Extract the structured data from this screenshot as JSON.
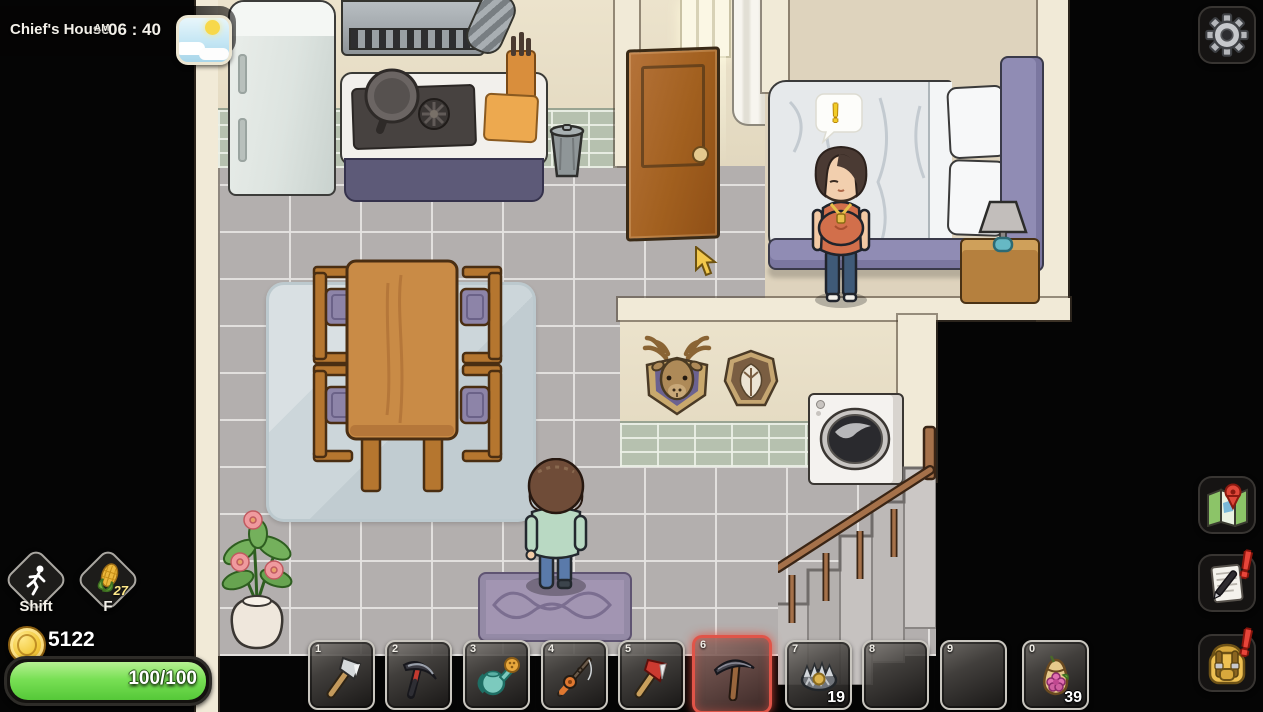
{
  "header": {
    "location": "Chief's House",
    "meridiem": "AM",
    "time": "06 : 40",
    "weather_icon": "sun-and-clouds"
  },
  "settings": {
    "icon": "gear"
  },
  "hud": {
    "shift_label": "Shift",
    "f_label": "F",
    "f_item_icon": "corn",
    "f_count": "27",
    "coins": "5122",
    "health": "100/100",
    "health_color": "#79e055",
    "coin_color": "#f2c93c"
  },
  "hotbar": {
    "selected_index": 5,
    "selected_color": "#e05448",
    "slots": [
      {
        "key": "1",
        "item": "axe",
        "count": ""
      },
      {
        "key": "2",
        "item": "scythe",
        "count": ""
      },
      {
        "key": "3",
        "item": "watering-can",
        "count": ""
      },
      {
        "key": "4",
        "item": "fishing-rod",
        "count": ""
      },
      {
        "key": "5",
        "item": "red-axe",
        "count": ""
      },
      {
        "key": "6",
        "item": "pickaxe",
        "count": ""
      },
      {
        "key": "7",
        "item": "bear-trap",
        "count": "19"
      },
      {
        "key": "8",
        "item": "",
        "count": ""
      },
      {
        "key": "9",
        "item": "",
        "count": ""
      },
      {
        "key": "0",
        "item": "seed-pouch",
        "count": "39"
      }
    ]
  },
  "sidebar": {
    "map": {
      "icon": "map-with-pin",
      "badge": ""
    },
    "journal": {
      "icon": "notepad-and-pen",
      "badge": "!"
    },
    "backpack": {
      "icon": "backpack",
      "badge": "!"
    }
  },
  "scene": {
    "npc_bubble": "!"
  }
}
